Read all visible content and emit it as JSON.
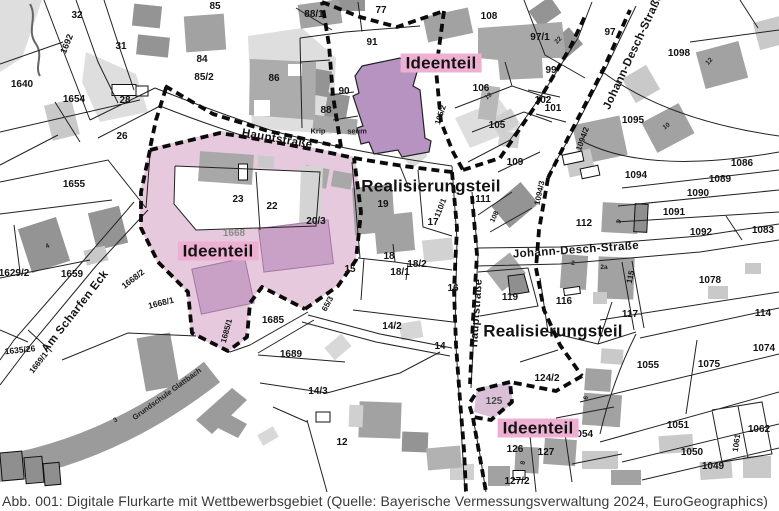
{
  "caption": "Abb. 001: Digitale Flurkarte mit Wettbewerbsgebiet (Quelle: Bayerische Vermessungsverwaltung 2024, EuroGeographics)",
  "colors": {
    "competition_area_pink": "#e7c9de",
    "inner_building_pink": "#c9a0c6",
    "church_purple": "#b793c1",
    "label_background": "#edb0d2",
    "building_gray": "#a2a2a2",
    "building_light_gray": "#c9c9c9",
    "boundary_black": "#0b0b0b"
  },
  "map": {
    "area_labels": [
      {
        "t": "Ideenteil",
        "x": 441,
        "y": 63,
        "bg": true
      },
      {
        "t": "Realisierungsteil",
        "x": 431,
        "y": 186
      },
      {
        "t": "Ideenteil",
        "x": 218,
        "y": 251,
        "bg": true
      },
      {
        "t": "Realisierungsteil",
        "x": 553,
        "y": 331
      },
      {
        "t": "Ideenteil",
        "x": 538,
        "y": 428,
        "bg": true
      }
    ],
    "street_labels": [
      {
        "t": "Hauptstraße",
        "x": 277,
        "y": 140,
        "r": 10
      },
      {
        "t": "Hauptstraße",
        "x": 477,
        "y": 313,
        "r": -86,
        "s": 11
      },
      {
        "t": "Johann-Desch-Straße",
        "x": 634,
        "y": 52,
        "r": -65
      },
      {
        "t": "Johann-Desch-Straße",
        "x": 576,
        "y": 251,
        "r": -4
      },
      {
        "t": "Am Scharfen Eck",
        "x": 76,
        "y": 312,
        "r": -52
      }
    ],
    "poi_labels": [
      {
        "t": "Grundschule Glattbach",
        "x": 167,
        "y": 394,
        "r": -36
      },
      {
        "t": "Krip",
        "x": 318,
        "y": 131
      },
      {
        "t": "seum",
        "x": 357,
        "y": 131
      }
    ],
    "parcel_labels": [
      {
        "t": "32",
        "x": 77,
        "y": 16
      },
      {
        "t": "31",
        "x": 121,
        "y": 47
      },
      {
        "t": "1640",
        "x": 22,
        "y": 85
      },
      {
        "t": "1654",
        "x": 74,
        "y": 100
      },
      {
        "t": "28",
        "x": 125,
        "y": 101
      },
      {
        "t": "26",
        "x": 122,
        "y": 137
      },
      {
        "t": "85",
        "x": 215,
        "y": 7
      },
      {
        "t": "84",
        "x": 202,
        "y": 60
      },
      {
        "t": "85/2",
        "x": 204,
        "y": 78
      },
      {
        "t": "86",
        "x": 274,
        "y": 79
      },
      {
        "t": "88/1",
        "x": 314,
        "y": 15
      },
      {
        "t": "77",
        "x": 381,
        "y": 11
      },
      {
        "t": "91",
        "x": 372,
        "y": 43
      },
      {
        "t": "90",
        "x": 344,
        "y": 92
      },
      {
        "t": "88",
        "x": 326,
        "y": 111
      },
      {
        "t": "108",
        "x": 489,
        "y": 17
      },
      {
        "t": "106",
        "x": 481,
        "y": 89
      },
      {
        "t": "105",
        "x": 497,
        "y": 126
      },
      {
        "t": "109",
        "x": 515,
        "y": 163
      },
      {
        "t": "97/1",
        "x": 540,
        "y": 38
      },
      {
        "t": "97",
        "x": 610,
        "y": 33
      },
      {
        "t": "99",
        "x": 551,
        "y": 71
      },
      {
        "t": "102",
        "x": 543,
        "y": 101
      },
      {
        "t": "101",
        "x": 553,
        "y": 109
      },
      {
        "t": "1098",
        "x": 679,
        "y": 54
      },
      {
        "t": "1095",
        "x": 633,
        "y": 121
      },
      {
        "t": "1094",
        "x": 636,
        "y": 176
      },
      {
        "t": "1089",
        "x": 720,
        "y": 180
      },
      {
        "t": "1090",
        "x": 698,
        "y": 194
      },
      {
        "t": "1091",
        "x": 674,
        "y": 213
      },
      {
        "t": "1092",
        "x": 701,
        "y": 233
      },
      {
        "t": "1083",
        "x": 763,
        "y": 231
      },
      {
        "t": "1086",
        "x": 742,
        "y": 164
      },
      {
        "t": "112",
        "x": 584,
        "y": 224
      },
      {
        "t": "111",
        "x": 483,
        "y": 200
      },
      {
        "t": "119",
        "x": 510,
        "y": 298
      },
      {
        "t": "116",
        "x": 564,
        "y": 302
      },
      {
        "t": "117",
        "x": 630,
        "y": 315
      },
      {
        "t": "1078",
        "x": 710,
        "y": 281
      },
      {
        "t": "114",
        "x": 763,
        "y": 314
      },
      {
        "t": "1655",
        "x": 74,
        "y": 185
      },
      {
        "t": "1629/2",
        "x": 14,
        "y": 274
      },
      {
        "t": "1659",
        "x": 72,
        "y": 275
      },
      {
        "t": "23",
        "x": 238,
        "y": 200
      },
      {
        "t": "22",
        "x": 272,
        "y": 207
      },
      {
        "t": "20/3",
        "x": 316,
        "y": 222
      },
      {
        "t": "1668",
        "x": 234,
        "y": 234,
        "c": "#8a8a8a"
      },
      {
        "t": "19",
        "x": 383,
        "y": 205
      },
      {
        "t": "17",
        "x": 433,
        "y": 223
      },
      {
        "t": "15",
        "x": 350,
        "y": 270
      },
      {
        "t": "18",
        "x": 389,
        "y": 257
      },
      {
        "t": "18/2",
        "x": 417,
        "y": 265
      },
      {
        "t": "18/1",
        "x": 400,
        "y": 273
      },
      {
        "t": "16",
        "x": 453,
        "y": 289
      },
      {
        "t": "1685",
        "x": 273,
        "y": 321
      },
      {
        "t": "14/2",
        "x": 392,
        "y": 327
      },
      {
        "t": "14",
        "x": 440,
        "y": 347
      },
      {
        "t": "1689",
        "x": 291,
        "y": 355
      },
      {
        "t": "14/3",
        "x": 318,
        "y": 392
      },
      {
        "t": "12",
        "x": 342,
        "y": 443
      },
      {
        "t": "125",
        "x": 494,
        "y": 402,
        "c": "#4a4a4a"
      },
      {
        "t": "124/2",
        "x": 547,
        "y": 379
      },
      {
        "t": "1054",
        "x": 582,
        "y": 435
      },
      {
        "t": "126",
        "x": 515,
        "y": 450
      },
      {
        "t": "127",
        "x": 546,
        "y": 453
      },
      {
        "t": "127/2",
        "x": 517,
        "y": 482
      },
      {
        "t": "1055",
        "x": 648,
        "y": 366
      },
      {
        "t": "1075",
        "x": 709,
        "y": 365
      },
      {
        "t": "1074",
        "x": 764,
        "y": 349
      },
      {
        "t": "1051",
        "x": 678,
        "y": 426
      },
      {
        "t": "1062",
        "x": 759,
        "y": 430
      },
      {
        "t": "1050",
        "x": 692,
        "y": 453
      },
      {
        "t": "1049",
        "x": 713,
        "y": 467
      }
    ],
    "small_labels": [
      {
        "t": "1692",
        "x": 67,
        "y": 44,
        "r": -68,
        "s": 9
      },
      {
        "t": "105/2",
        "x": 441,
        "y": 115,
        "r": -72
      },
      {
        "t": "110/1",
        "x": 441,
        "y": 208,
        "r": -68
      },
      {
        "t": "1094/2",
        "x": 583,
        "y": 139,
        "r": -70
      },
      {
        "t": "1094/3",
        "x": 540,
        "y": 193,
        "r": -78
      },
      {
        "t": "115",
        "x": 631,
        "y": 277,
        "r": -78
      },
      {
        "t": "1061",
        "x": 737,
        "y": 443,
        "r": -82
      },
      {
        "t": "1685/1",
        "x": 227,
        "y": 331,
        "r": -75
      },
      {
        "t": "1668/2",
        "x": 133,
        "y": 279,
        "r": -38,
        "s": 8.5
      },
      {
        "t": "1668/1",
        "x": 161,
        "y": 303,
        "r": -14,
        "s": 8.5
      },
      {
        "t": "1669/1",
        "x": 39,
        "y": 363,
        "r": -52
      },
      {
        "t": "65/3",
        "x": 328,
        "y": 304,
        "r": -62
      },
      {
        "t": "108",
        "x": 495,
        "y": 217,
        "r": -65,
        "s": 7
      },
      {
        "t": "1635/26",
        "x": 20,
        "y": 350,
        "r": -6,
        "s": 8.5
      }
    ],
    "house_numbers": [
      {
        "t": "4",
        "x": 48,
        "y": 247,
        "r": -25
      },
      {
        "t": "3",
        "x": 116,
        "y": 421,
        "r": -33
      },
      {
        "t": "2",
        "x": 573,
        "y": 264
      },
      {
        "t": "2a",
        "x": 604,
        "y": 268
      },
      {
        "t": "12",
        "x": 710,
        "y": 62,
        "r": -50
      },
      {
        "t": "10",
        "x": 667,
        "y": 127,
        "r": -35
      },
      {
        "t": "19",
        "x": 489,
        "y": 97,
        "r": -40
      },
      {
        "t": "9",
        "x": 620,
        "y": 222,
        "r": -60
      },
      {
        "t": "6",
        "x": 587,
        "y": 398,
        "r": -75
      },
      {
        "t": "8",
        "x": 524,
        "y": 463,
        "r": -75
      },
      {
        "t": "22",
        "x": 559,
        "y": 41,
        "r": -45
      }
    ]
  }
}
